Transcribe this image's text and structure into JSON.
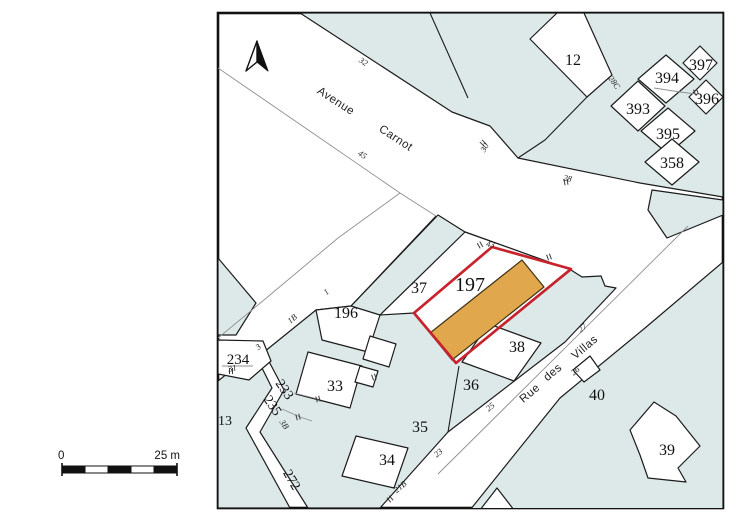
{
  "colors": {
    "parcel_fill": "#dde9e9",
    "parcel_stroke": "#1b1b1b",
    "thin_line": "#8f8f8f",
    "highlight_outline": "#c8232d",
    "building_fill": "#e0a74c",
    "frame": "#111111"
  },
  "north_arrow": {
    "icon": "north-arrow"
  },
  "scale_bar": {
    "start": "0",
    "end": "25 m"
  },
  "streets": [
    {
      "name": "Avenue Carnot",
      "words": [
        {
          "text": "Avenue",
          "x": 334,
          "y": 104,
          "rot": 33
        },
        {
          "text": "Carnot",
          "x": 394,
          "y": 141,
          "rot": 33
        }
      ]
    },
    {
      "name": "Rue des Villas",
      "words": [
        {
          "text": "Rue",
          "x": 532,
          "y": 396,
          "rot": -40
        },
        {
          "text": "des",
          "x": 555,
          "y": 375,
          "rot": -40
        },
        {
          "text": "Villas",
          "x": 587,
          "y": 350,
          "rot": -40
        }
      ]
    }
  ],
  "parcels": [
    {
      "number": "12",
      "x": 573,
      "y": 65,
      "size": 16,
      "rot": 0,
      "highlighted": false
    },
    {
      "number": "394",
      "x": 667,
      "y": 83,
      "size": 16,
      "rot": 0,
      "highlighted": false
    },
    {
      "number": "397",
      "x": 701,
      "y": 70,
      "size": 16,
      "rot": 0,
      "highlighted": false
    },
    {
      "number": "393",
      "x": 638,
      "y": 114,
      "size": 16,
      "rot": 0,
      "highlighted": false
    },
    {
      "number": "396",
      "x": 707,
      "y": 104,
      "size": 16,
      "rot": 0,
      "highlighted": false
    },
    {
      "number": "395",
      "x": 668,
      "y": 139,
      "size": 16,
      "rot": 0,
      "highlighted": false
    },
    {
      "number": "358",
      "x": 672,
      "y": 168,
      "size": 16,
      "rot": 0,
      "highlighted": false
    },
    {
      "number": "196",
      "x": 346,
      "y": 318,
      "size": 16,
      "rot": 0,
      "highlighted": false
    },
    {
      "number": "37",
      "x": 419,
      "y": 293,
      "size": 16,
      "rot": 0,
      "highlighted": false
    },
    {
      "number": "197",
      "x": 470,
      "y": 291,
      "size": 20,
      "rot": 0,
      "highlighted": true
    },
    {
      "number": "38",
      "x": 517,
      "y": 352,
      "size": 16,
      "rot": 0,
      "highlighted": false
    },
    {
      "number": "36",
      "x": 471,
      "y": 390,
      "size": 16,
      "rot": 0,
      "highlighted": false
    },
    {
      "number": "35",
      "x": 420,
      "y": 432,
      "size": 16,
      "rot": 0,
      "highlighted": false
    },
    {
      "number": "34",
      "x": 387,
      "y": 465,
      "size": 16,
      "rot": 0,
      "highlighted": false
    },
    {
      "number": "33",
      "x": 335,
      "y": 391,
      "size": 16,
      "rot": 0,
      "highlighted": false
    },
    {
      "number": "40",
      "x": 597,
      "y": 400,
      "size": 16,
      "rot": 0,
      "highlighted": false
    },
    {
      "number": "39",
      "x": 667,
      "y": 455,
      "size": 16,
      "rot": 0,
      "highlighted": false
    },
    {
      "number": "234",
      "x": 238,
      "y": 364,
      "size": 15,
      "rot": 0,
      "highlighted": false
    },
    {
      "number": "233",
      "x": 281,
      "y": 392,
      "size": 14,
      "rot": 55,
      "highlighted": false
    },
    {
      "number": "235",
      "x": 269,
      "y": 408,
      "size": 14,
      "rot": 55,
      "highlighted": false
    },
    {
      "number": "272",
      "x": 288,
      "y": 482,
      "size": 14,
      "rot": 60,
      "highlighted": false
    },
    {
      "number": "13",
      "x": 225,
      "y": 425,
      "size": 14,
      "rot": 0,
      "highlighted": false
    }
  ],
  "house_numbers": [
    {
      "text": "32",
      "x": 362,
      "y": 64,
      "rot": 33
    },
    {
      "text": "45",
      "x": 361,
      "y": 157,
      "rot": 33
    },
    {
      "text": "30",
      "x": 487,
      "y": 149,
      "rot": -60
    },
    {
      "text": "28",
      "x": 567,
      "y": 181,
      "rot": 12
    },
    {
      "text": "28C",
      "x": 612,
      "y": 84,
      "rot": 55
    },
    {
      "text": "43",
      "x": 490,
      "y": 247,
      "rot": 10
    },
    {
      "text": "27",
      "x": 584,
      "y": 330,
      "rot": -40
    },
    {
      "text": "26",
      "x": 577,
      "y": 373,
      "rot": -40
    },
    {
      "text": "25",
      "x": 492,
      "y": 409,
      "rot": -40
    },
    {
      "text": "23",
      "x": 440,
      "y": 455,
      "rot": -40
    },
    {
      "text": "21B",
      "x": 402,
      "y": 489,
      "rot": -40
    },
    {
      "text": "1",
      "x": 328,
      "y": 294,
      "rot": -40
    },
    {
      "text": "1B",
      "x": 294,
      "y": 321,
      "rot": -40
    },
    {
      "text": "3",
      "x": 260,
      "y": 349,
      "rot": -40
    },
    {
      "text": "3B",
      "x": 282,
      "y": 426,
      "rot": 55
    },
    {
      "text": "31",
      "x": 233,
      "y": 371,
      "rot": -15
    }
  ]
}
